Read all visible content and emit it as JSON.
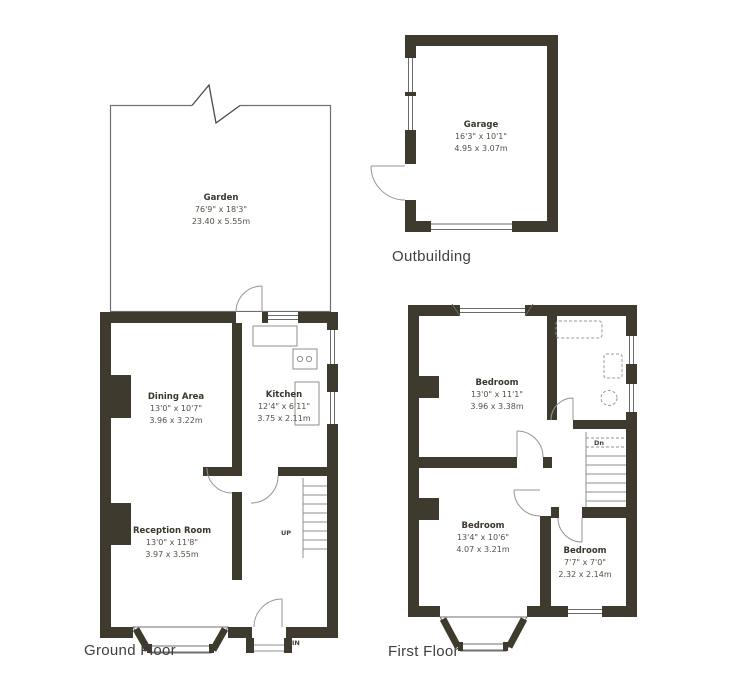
{
  "title": "Property floorplan",
  "colors": {
    "wall": "#3f3a2e",
    "thin_line": "#8f8f8f",
    "outline": "#6f6f6f",
    "room_text": "#3a362c",
    "dim_text": "#545046"
  },
  "floors": {
    "ground": {
      "label": "Ground Floor"
    },
    "first": {
      "label": "First Floor"
    },
    "outbuilding": {
      "label": "Outbuilding"
    }
  },
  "rooms": {
    "garden": {
      "name": "Garden",
      "imperial": "76'9\" x 18'3\"",
      "metric": "23.40 x 5.55m"
    },
    "dining": {
      "name": "Dining Area",
      "imperial": "13'0\" x 10'7\"",
      "metric": "3.96 x 3.22m"
    },
    "kitchen": {
      "name": "Kitchen",
      "imperial": "12'4\" x 6'11\"",
      "metric": "3.75 x 2.11m"
    },
    "reception": {
      "name": "Reception Room",
      "imperial": "13'0\" x 11'8\"",
      "metric": "3.97 x 3.55m"
    },
    "garage": {
      "name": "Garage",
      "imperial": "16'3\" x 10'1\"",
      "metric": "4.95 x 3.07m"
    },
    "bedroom1": {
      "name": "Bedroom",
      "imperial": "13'0\" x 11'1\"",
      "metric": "3.96 x 3.38m"
    },
    "bedroom2": {
      "name": "Bedroom",
      "imperial": "13'4\" x 10'6\"",
      "metric": "4.07 x 3.21m"
    },
    "bedroom3": {
      "name": "Bedroom",
      "imperial": "7'7\" x 7'0\"",
      "metric": "2.32 x 2.14m"
    }
  },
  "annotations": {
    "stairs_up": "UP",
    "stairs_down": "Dn",
    "entrance": "IN"
  }
}
